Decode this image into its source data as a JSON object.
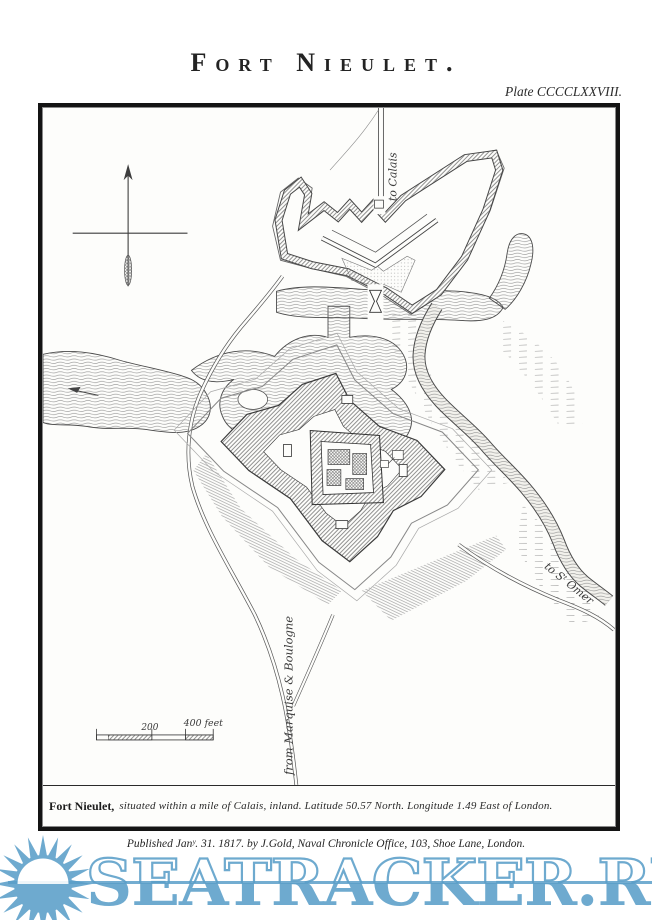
{
  "plate": {
    "title": "Fort Nieulet.",
    "plate_number": "Plate CCCCLXXVIII.",
    "caption_lead": "Fort Nieulet,",
    "caption_rest": "situated within a mile of Calais, inland. Latitude 50.57 North. Longitude 1.49 East of London.",
    "imprint": "Published Janʸ. 31. 1817. by J.Gold, Naval Chronicle Office, 103, Shoe Lane, London."
  },
  "map": {
    "labels": {
      "to_calais": "to Calais",
      "to_st_omer": "to Sᵗ Omer",
      "from_marquise_boulogne": "from Marquise & Boulogne"
    },
    "scale_bar": {
      "mid_label": "200",
      "end_label": "400 feet"
    }
  },
  "watermark": {
    "site": "SEATRACKER.RU",
    "color": "#5b9fc9"
  }
}
